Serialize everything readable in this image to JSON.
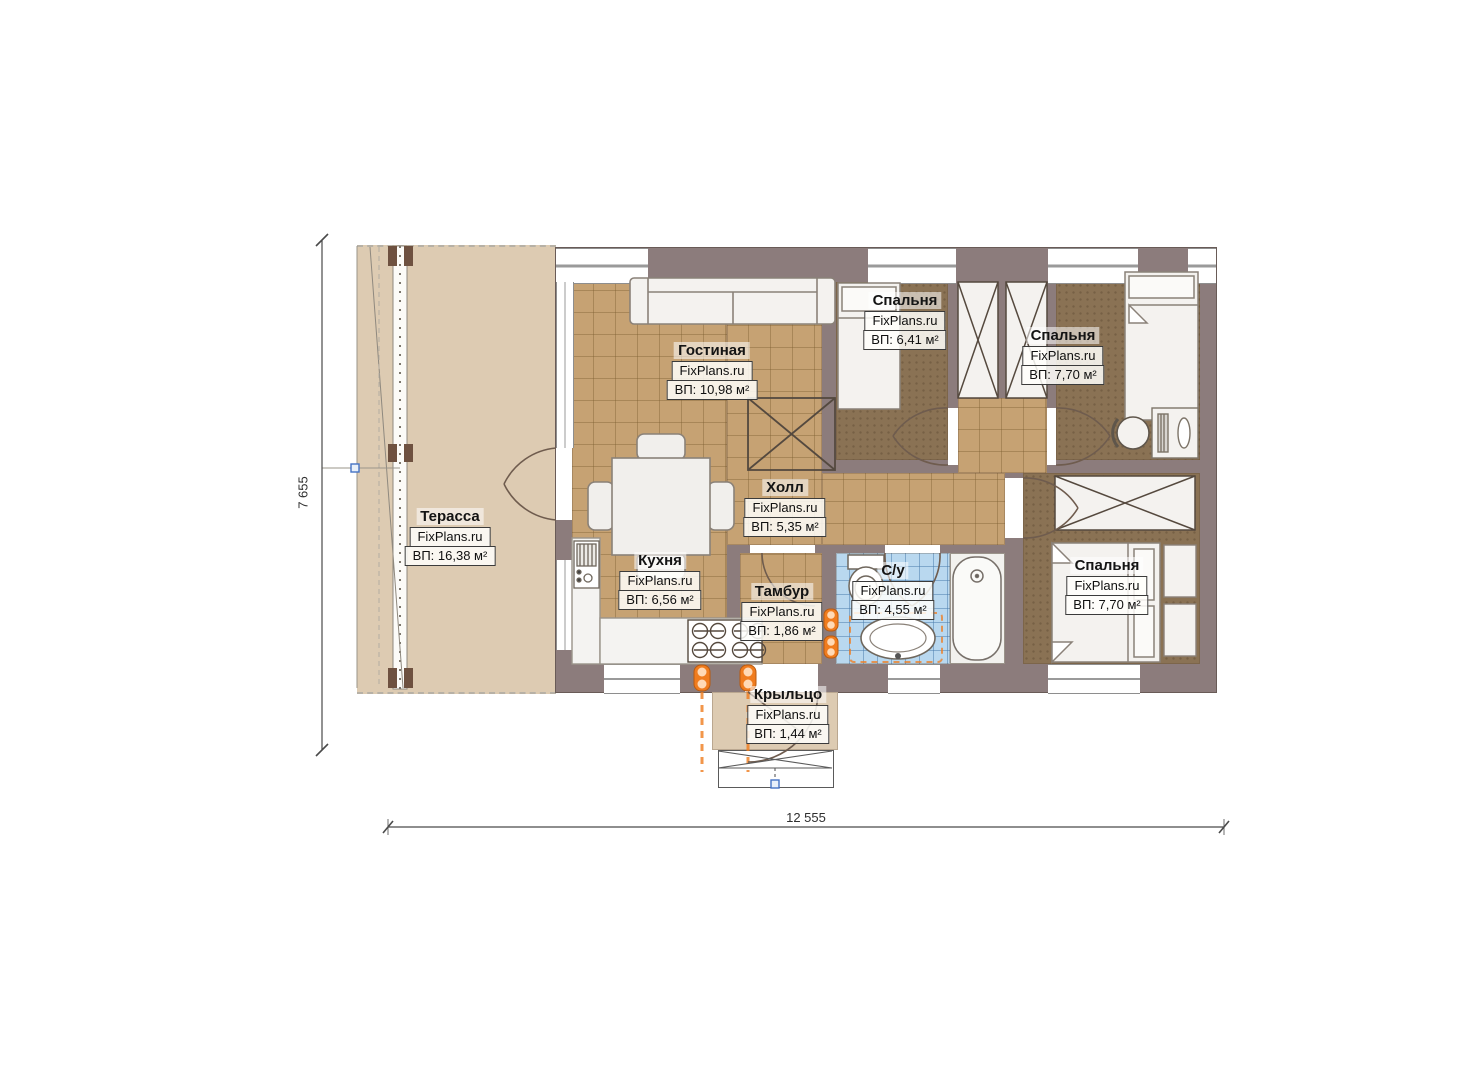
{
  "plan": {
    "watermark": "FixPlans.ru",
    "rooms": [
      {
        "id": "terrace",
        "name": "Терасса",
        "area": "ВП: 16,38 м²"
      },
      {
        "id": "living",
        "name": "Гостиная",
        "area": "ВП: 10,98 м²"
      },
      {
        "id": "bedroom-top",
        "name": "Спальня",
        "area": "ВП: 6,41 м²"
      },
      {
        "id": "bedroom-right",
        "name": "Спальня",
        "area": "ВП: 7,70 м²"
      },
      {
        "id": "hall",
        "name": "Холл",
        "area": "ВП: 5,35 м²"
      },
      {
        "id": "kitchen",
        "name": "Кухня",
        "area": "ВП: 6,56 м²"
      },
      {
        "id": "tambour",
        "name": "Тамбур",
        "area": "ВП: 1,86 м²"
      },
      {
        "id": "bathroom",
        "name": "С/у",
        "area": "ВП: 4,55 м²"
      },
      {
        "id": "bedroom-bottom",
        "name": "Спальня",
        "area": "ВП: 7,70 м²"
      },
      {
        "id": "porch",
        "name": "Крыльцо",
        "area": "ВП: 1,44 м²"
      }
    ],
    "dimensions": {
      "height": "7 655",
      "width": "12 555"
    },
    "colors": {
      "wall": "#8c7c7c",
      "terrace_floor": "#ddcbb2",
      "tile_floor": "#c6a273",
      "bedroom_floor": "#8a7254",
      "bathroom_floor": "#b9d8ef",
      "radiator": "#f07c1e",
      "marker_blue": "#4472c4"
    }
  }
}
